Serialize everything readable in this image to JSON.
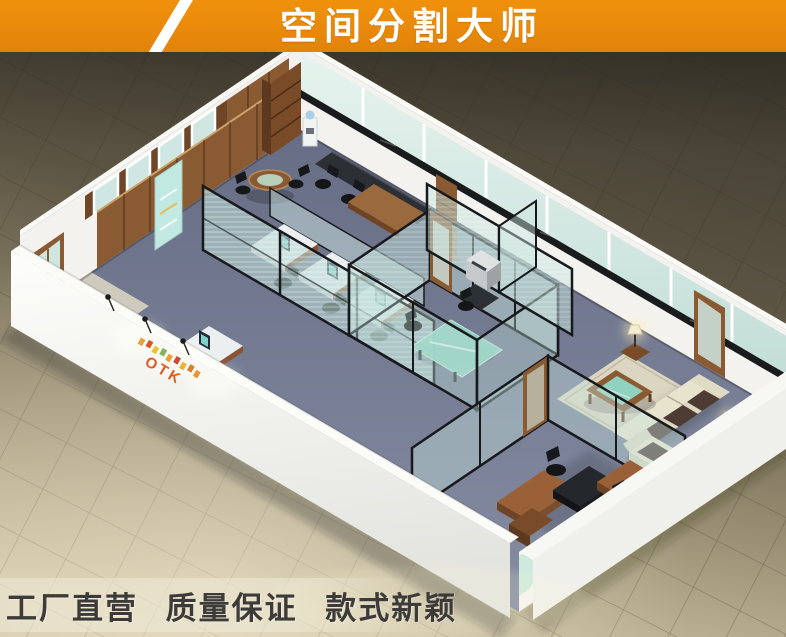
{
  "banner": {
    "title": "空间分割大师"
  },
  "footer": {
    "slogans": [
      "工厂直营",
      "质量保证",
      "款式新颖"
    ]
  },
  "scene": {
    "wall_logo": "OTK",
    "colors": {
      "banner_orange": "#f0910c",
      "banner_orange_dark": "#e2830a",
      "stripe_white": "#ffffff",
      "title_white": "#ffffff",
      "footer_text": "#3c3b38",
      "floor_dark": "#474034",
      "floor_light": "#cfc5a8",
      "carpet_blue": "#757c92",
      "wood": "#8a5a33",
      "wood_dark": "#6e4526",
      "glass": "#cfe6e2",
      "frame_black": "#17191c",
      "wall_white": "#f3f2ee",
      "sofa_cream": "#e8e3cd",
      "cushion_brown": "#4e3c34",
      "glass_green": "#8fd2bf",
      "poster_teal": "#c2e9e1"
    }
  }
}
